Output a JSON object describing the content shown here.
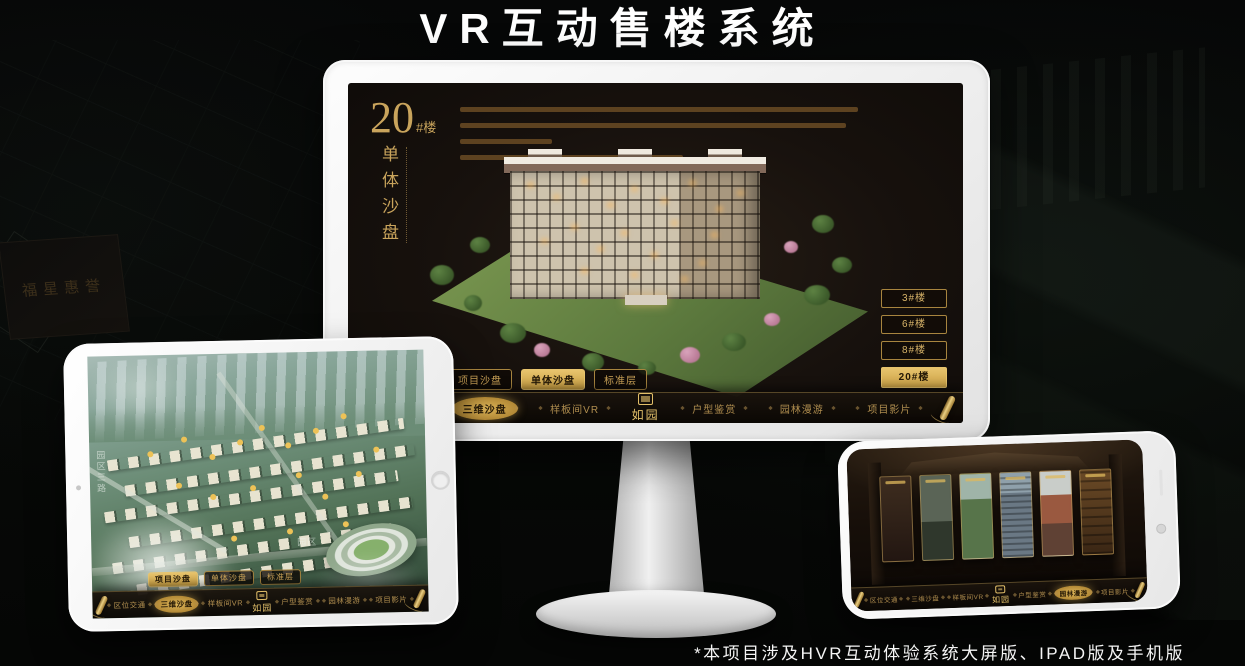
{
  "page": {
    "title": "VR互动售楼系统",
    "footnote": "*本项目涉及HVR互动体验系统大屏版、IPAD版及手机版"
  },
  "colors": {
    "gold": "#C9A45C",
    "gold_bright": "#E8C46D",
    "screen_bg": "#17110D"
  },
  "background": {
    "plaque_text": "福星惠誉"
  },
  "monitor": {
    "block": {
      "number": "20",
      "unit": "#楼",
      "caption": "单体沙盘"
    },
    "floor_buttons": [
      {
        "label": "3#楼",
        "active": false
      },
      {
        "label": "6#楼",
        "active": false
      },
      {
        "label": "8#楼",
        "active": false
      },
      {
        "label": "20#楼",
        "active": true
      }
    ],
    "sub_tabs": [
      {
        "label": "项目沙盘",
        "active": false
      },
      {
        "label": "单体沙盘",
        "active": true
      },
      {
        "label": "标准层",
        "active": false
      }
    ],
    "nav_items": [
      {
        "label": "区位交通",
        "active": false
      },
      {
        "label": "三维沙盘",
        "active": true
      },
      {
        "label": "样板间VR",
        "active": false
      },
      {
        "label": "如园",
        "type": "logo"
      },
      {
        "label": "户型鉴赏",
        "active": false
      },
      {
        "label": "园林漫游",
        "active": false
      },
      {
        "label": "项目影片",
        "active": false
      }
    ]
  },
  "tablet": {
    "sub_tabs": [
      {
        "label": "项目沙盘",
        "active": true
      },
      {
        "label": "单体沙盘",
        "active": false
      },
      {
        "label": "标准层",
        "active": false
      }
    ],
    "nav_items": [
      {
        "label": "区位交通",
        "active": false
      },
      {
        "label": "三维沙盘",
        "active": true
      },
      {
        "label": "样板间VR",
        "active": false
      },
      {
        "label": "如园",
        "type": "logo"
      },
      {
        "label": "户型鉴赏",
        "active": false
      },
      {
        "label": "园林漫游",
        "active": false
      },
      {
        "label": "项目影片",
        "active": false
      }
    ],
    "map_labels": {
      "road": "园区三路",
      "area": "园区"
    }
  },
  "phone": {
    "nav_items": [
      {
        "label": "区位交通",
        "active": false
      },
      {
        "label": "三维沙盘",
        "active": false
      },
      {
        "label": "样板间VR",
        "active": false
      },
      {
        "label": "如园",
        "type": "logo"
      },
      {
        "label": "户型鉴赏",
        "active": false
      },
      {
        "label": "园林漫游",
        "active": true
      },
      {
        "label": "项目影片",
        "active": false
      }
    ]
  }
}
